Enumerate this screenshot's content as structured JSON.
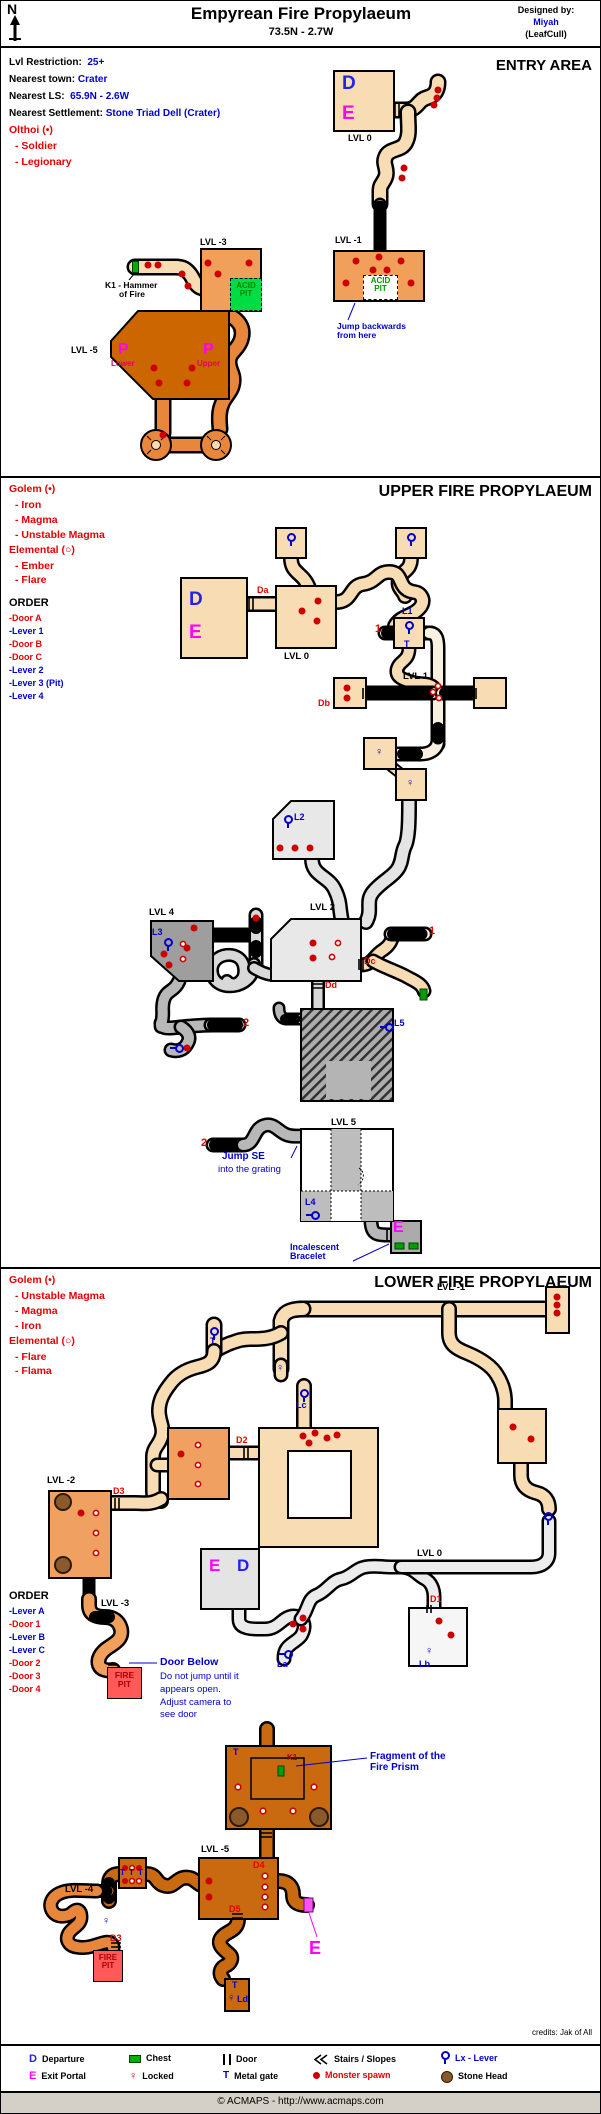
{
  "colors": {
    "tan": "#F8DCB4",
    "orange": "#F0A05A",
    "dark_orange": "#C96A10",
    "spiral_orange": "#E8873C",
    "light_gray": "#E8E8E8",
    "dark_gray": "#9E9E9E",
    "green": "#00DD44",
    "chest_green": "#00B000",
    "blue": "#0000CC",
    "red": "#E60000",
    "magenta": "#FF00FF",
    "brown": "#8B5A2B",
    "fire_red": "#FF5959"
  },
  "icons": {
    "gate": "T",
    "lock": "♀",
    "compass": "N"
  },
  "header": {
    "title": "Empyrean Fire Propylaeum",
    "coords": "73.5N - 2.7W",
    "designed_by": "Designed by:",
    "designer": "Miyah",
    "designer_guild": "(LeafCull)"
  },
  "entry": {
    "title": "ENTRY AREA",
    "info": [
      {
        "label": "Lvl Restriction:",
        "value": "25+"
      },
      {
        "label": "Nearest town:",
        "value": "Crater"
      },
      {
        "label": "Nearest LS:",
        "value": "65.9N - 2.6W"
      },
      {
        "label": "Nearest Settlement:",
        "value": "Stone Triad Dell (Crater)"
      }
    ],
    "monsters_title": "Olthoi (•)",
    "monsters": [
      "- Soldier",
      "- Legionary"
    ],
    "labels": {
      "d": "D",
      "e": "E",
      "lvl0": "LVL 0",
      "lvl_m1": "LVL -1",
      "lvl_m3": "LVL -3",
      "lvl_m5": "LVL -5",
      "acid_pit": "ACID PIT",
      "k1_1": "K1 - Hammer",
      "k1_2": "of Fire",
      "p": "P",
      "lower": "Lower",
      "upper": "Upper",
      "jump_1": "Jump backwards",
      "jump_2": "from here"
    }
  },
  "upper": {
    "title": "UPPER FIRE PROPYLAEUM",
    "monsters_title": "Golem (•)",
    "monsters": [
      "- Iron",
      "- Magma",
      "- Unstable Magma"
    ],
    "monsters2_title": "Elemental (○)",
    "monsters2": [
      "- Ember",
      "- Flare"
    ],
    "order_title": "ORDER",
    "order": [
      "-Door A",
      "-Lever 1",
      "-Door B",
      "-Door C",
      "-Lever 2",
      "-Lever 3 (Pit)",
      "-Lever 4"
    ],
    "labels": {
      "da": "Da",
      "db": "Db",
      "dc": "Dc",
      "dd": "Dd",
      "l1": "L1",
      "l2": "L2",
      "l3": "L3",
      "l4": "L4",
      "l5": "L5",
      "t": "T",
      "one": "1",
      "two": "2",
      "lvl0": "LVL 0",
      "lvl1": "LVL 1",
      "lvl2": "LVL 2",
      "lvl4": "LVL 4",
      "lvl5": "LVL 5",
      "e": "E",
      "jump_1": "Jump SE",
      "jump_2": "into the grating",
      "bracelet_1": "Incalescent",
      "bracelet_2": "Bracelet"
    }
  },
  "lower": {
    "title": "LOWER FIRE PROPYLAEUM",
    "monsters_title": "Golem (•)",
    "monsters": [
      "- Unstable Magma",
      "- Magma",
      "- Iron"
    ],
    "monsters2_title": "Elemental (○)",
    "monsters2": [
      "- Flare",
      "- Flama"
    ],
    "order_title": "ORDER",
    "order": [
      "-Lever A",
      "-Door 1",
      "-Lever B",
      "-Lever C",
      "-Door 2",
      "-Door 3",
      "-Door 4"
    ],
    "labels": {
      "lvl_m1": "LVL -1",
      "lvl_m2": "LVL -2",
      "lvl_m3": "LVL -3",
      "lvl_m4": "LVL -4",
      "lvl_m5": "LVL -5",
      "lvl0": "LVL 0",
      "d1": "D1",
      "d2": "D2",
      "d3": "D3",
      "d4": "D4",
      "d5": "D5",
      "la": "La",
      "lb": "Lb",
      "lc": "Lc",
      "ld": "Ld",
      "k1": "K1",
      "t": "T",
      "e": "E",
      "ed_e": "E",
      "ed_d": "D",
      "fire_pit": "FIRE PIT",
      "door_below": "Door Below",
      "door_below_2": "Do not jump until it",
      "door_below_3": "appears open.",
      "door_below_4": "Adjust camera to",
      "door_below_5": "see door",
      "fragment_1": "Fragment of the",
      "fragment_2": "Fire Prism"
    }
  },
  "legend": {
    "departure_sym": "D",
    "departure": "Departure",
    "exit_sym": "E",
    "exit": "Exit Portal",
    "chest": "Chest",
    "locked": "Locked",
    "door": "Door",
    "metal_gate": "Metal gate",
    "stairs": "Stairs / Slopes",
    "monster_spawn": "Monster spawn",
    "lever": "Lx - Lever",
    "stone_head": "Stone Head"
  },
  "credits": "credits: Jak of All",
  "footer": "© ACMAPS - http://www.acmaps.com"
}
